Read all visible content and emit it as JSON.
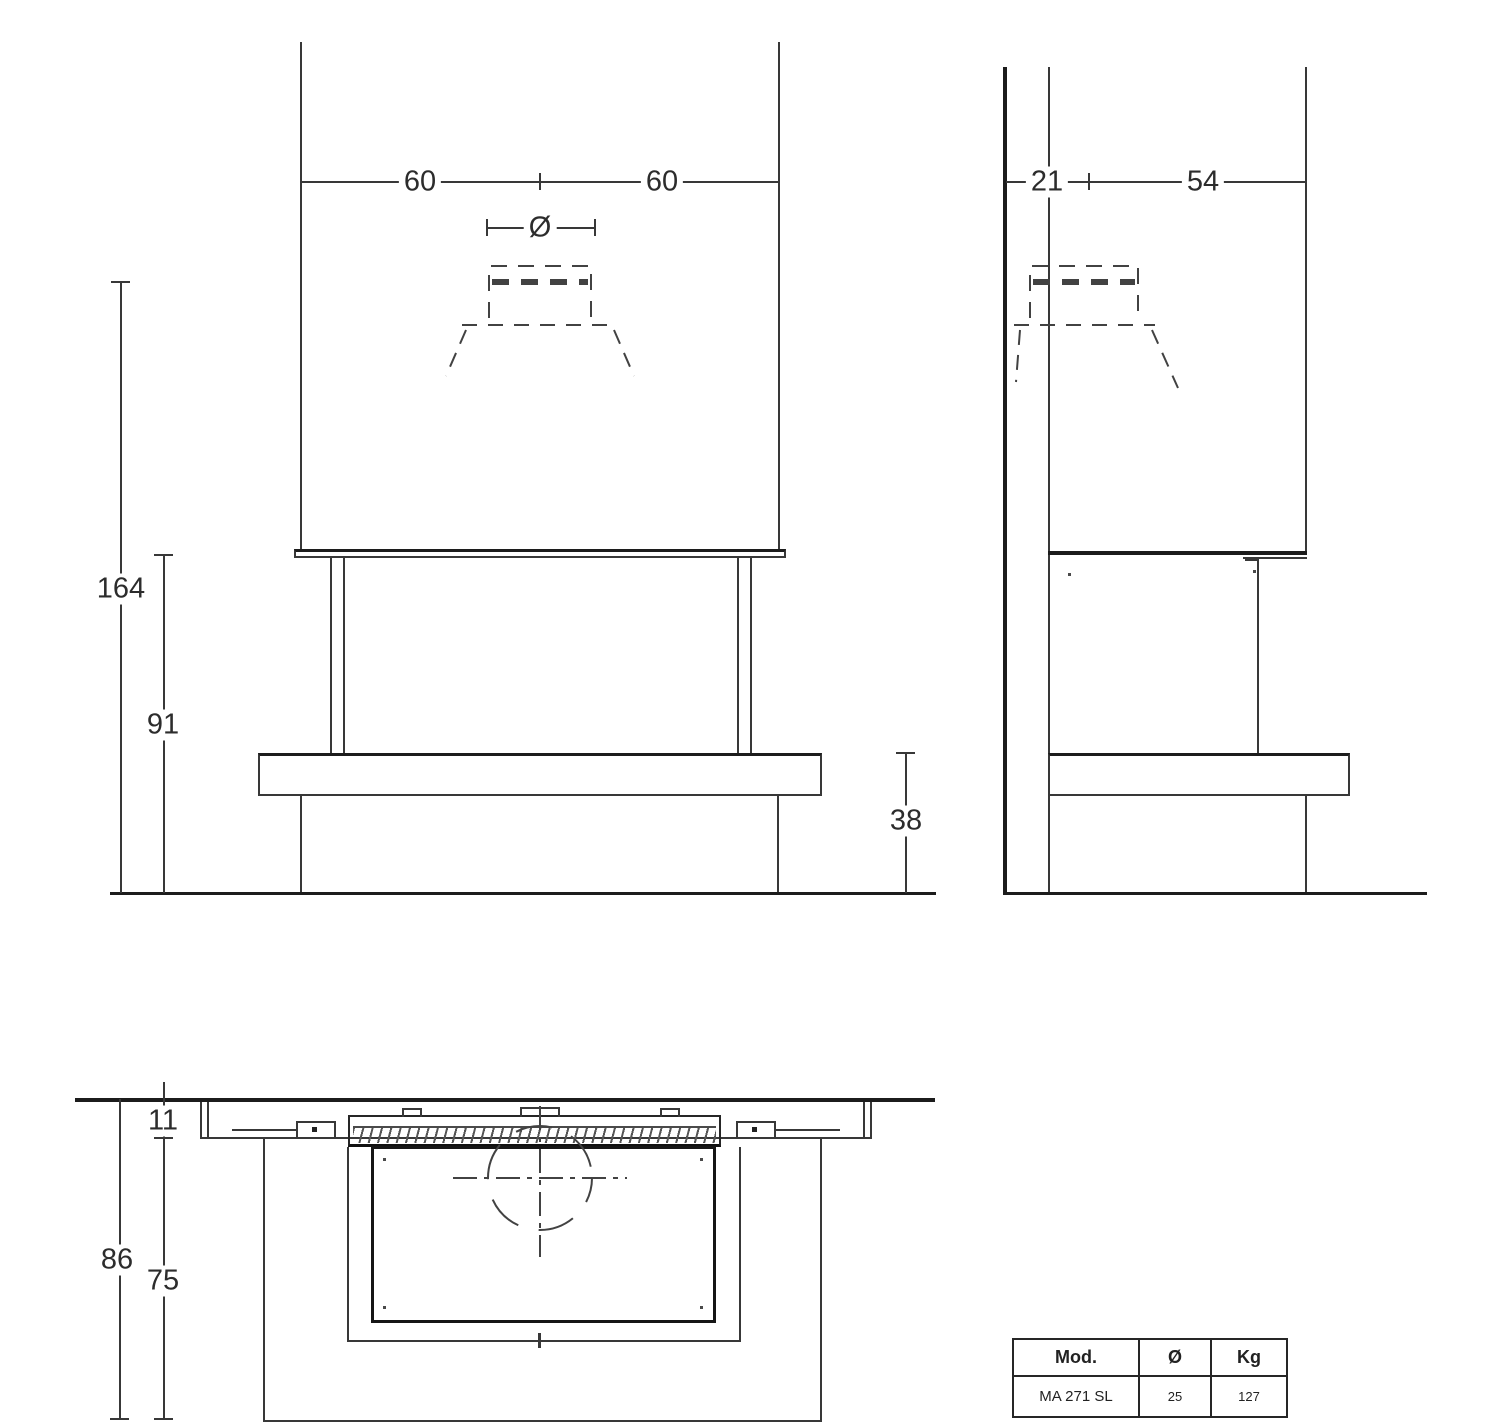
{
  "drawing": {
    "front_view": {
      "dim_width_left": "60",
      "dim_width_right": "60",
      "dim_flue_diameter_symbol": "Ø",
      "dim_height_total": "164",
      "dim_height_opening": "91",
      "dim_bench_height": "38"
    },
    "side_view": {
      "dim_wall_offset": "21",
      "dim_depth": "54"
    },
    "plan_view": {
      "dim_panel_depth": "11",
      "dim_total_depth": "86",
      "dim_base_depth": "75"
    },
    "spec_table": {
      "headers": [
        "Mod.",
        "Ø",
        "Kg"
      ],
      "rows": [
        [
          "MA 271 SL",
          "25",
          "127"
        ]
      ]
    }
  }
}
